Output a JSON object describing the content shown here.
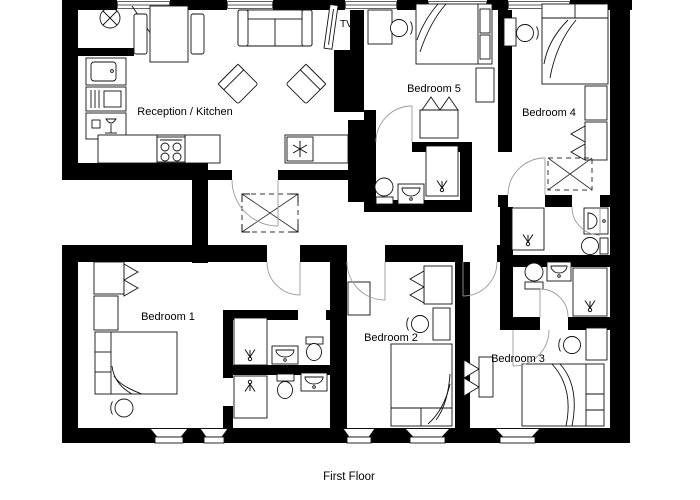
{
  "floor_label": "First Floor",
  "rooms": [
    {
      "id": "reception-kitchen",
      "label": "Reception / Kitchen"
    },
    {
      "id": "bedroom-5",
      "label": "Bedroom 5"
    },
    {
      "id": "bedroom-4",
      "label": "Bedroom 4"
    },
    {
      "id": "bedroom-1",
      "label": "Bedroom 1"
    },
    {
      "id": "bedroom-2",
      "label": "Bedroom 2"
    },
    {
      "id": "bedroom-3",
      "label": "Bedroom 3"
    }
  ],
  "annotations": {
    "tv": "TV"
  },
  "colors": {
    "wall": "#000000",
    "background": "#ffffff",
    "furniture_line": "#111111",
    "door_arc": "#9a9a9a"
  }
}
